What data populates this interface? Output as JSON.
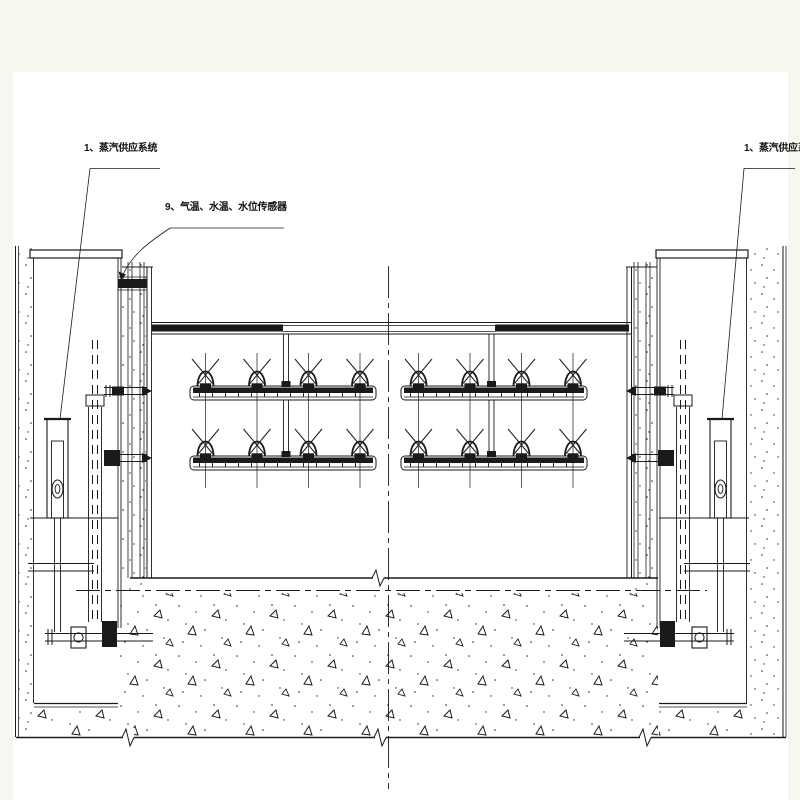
{
  "labels": {
    "left_system": "1、蒸汽供应系统",
    "sensors": "9、气温、水温、水位传感器",
    "right_system": "1、蒸汽供应系统"
  },
  "colors": {
    "ink": "#1a1a1a",
    "paper": "#ffffff",
    "margin": "#f5f8ee"
  }
}
